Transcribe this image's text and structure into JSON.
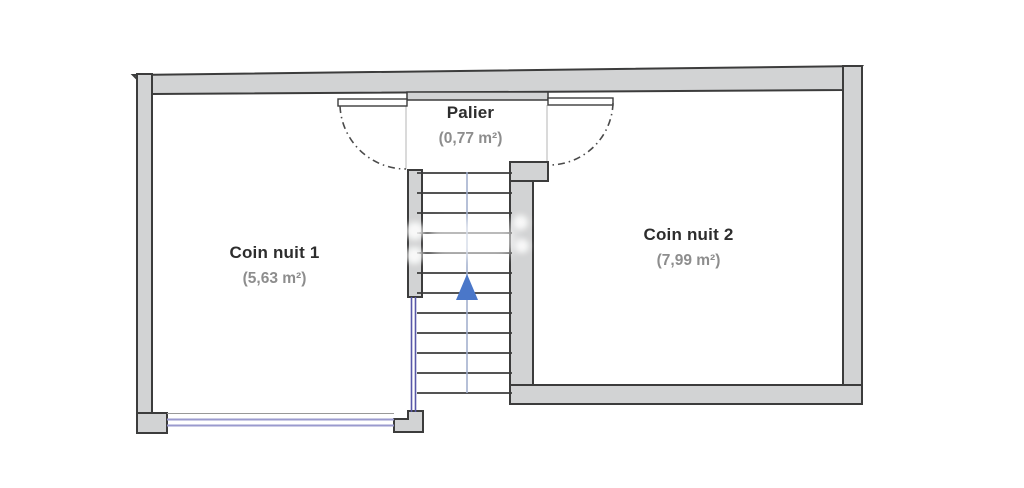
{
  "plan": {
    "rooms": [
      {
        "id": "palier",
        "name": "Palier",
        "area": "(0,77 m²)"
      },
      {
        "id": "coin-nuit-1",
        "name": "Coin nuit 1",
        "area": "(5,63 m²)"
      },
      {
        "id": "coin-nuit-2",
        "name": "Coin nuit 2",
        "area": "(7,99 m²)"
      }
    ],
    "stairs": {
      "icon": "up-arrow",
      "treads": 12
    },
    "colors": {
      "background": "#ffffff",
      "wall_fill": "#d2d3d4",
      "wall_outline": "#3c3c3c",
      "window_glass": "#9a9ace",
      "railing": "#5757a8",
      "stair_center_line": "#9daccb",
      "door_arc": "#4a4a4a",
      "arrow": "#4a77c9",
      "room_name_text": "#2d2d2d",
      "room_area_text": "#8d8d8d"
    }
  }
}
